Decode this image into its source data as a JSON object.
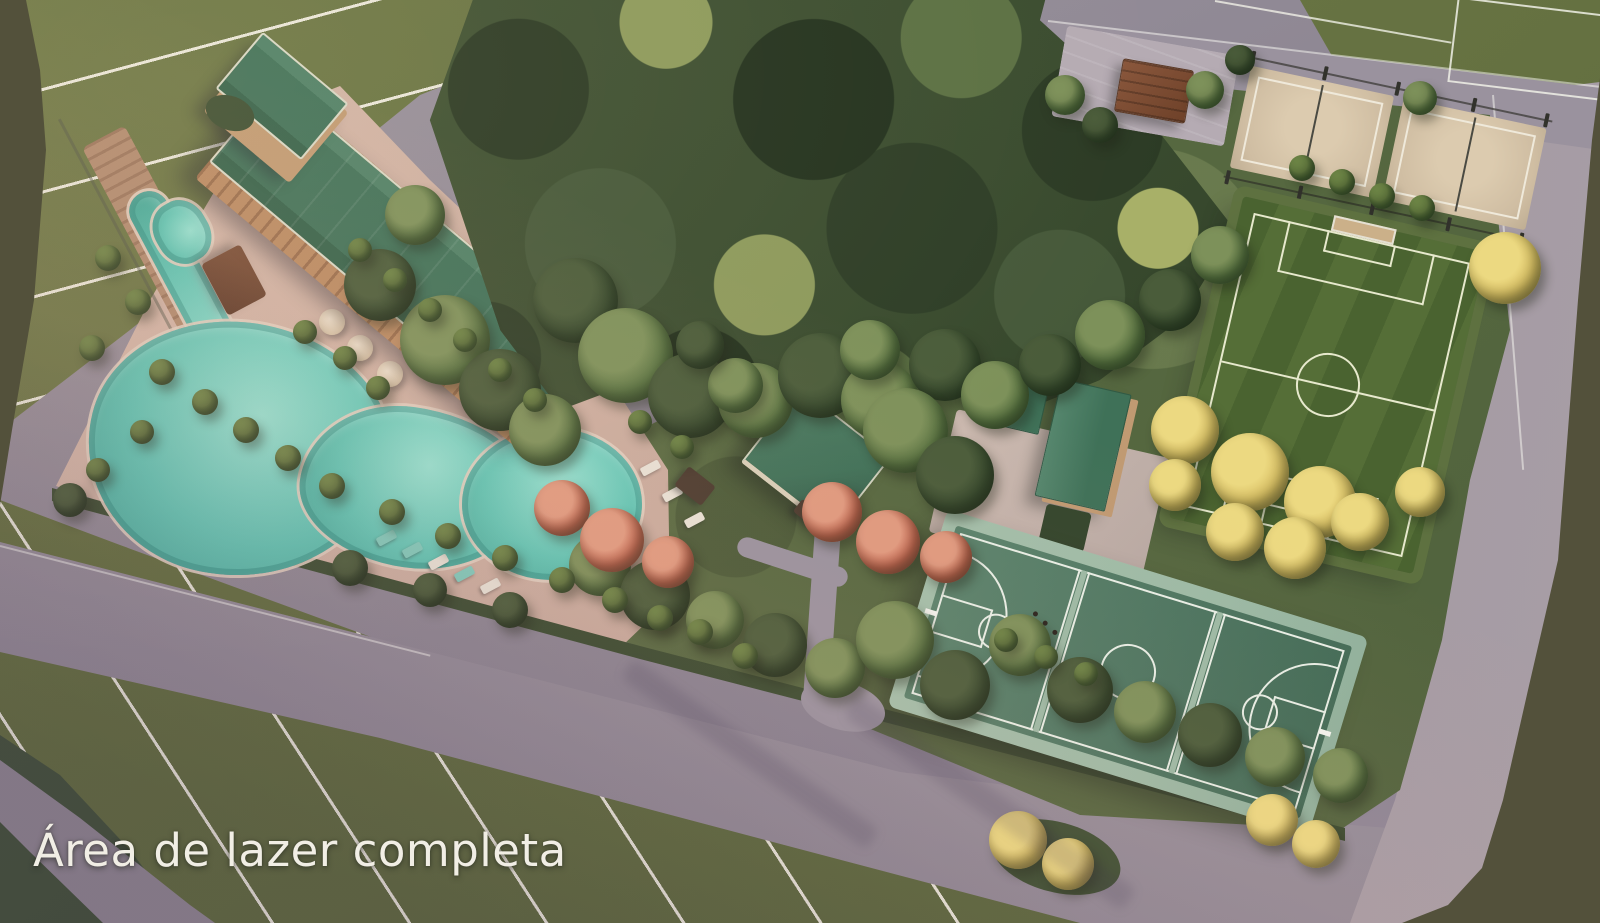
{
  "caption": {
    "text": "Área de lazer completa"
  },
  "palette": {
    "frame": "#53513b",
    "road": "#8f8894",
    "grass_lot": "#66713f",
    "lawn": "#5a6c41",
    "forest": "#3a4c2f",
    "pool": "#5ec5b4",
    "pool_light": "#93e0d0",
    "roof_green": "#3f7158",
    "deck": "#c9ac9f",
    "wall_tan": "#b98a62",
    "court_dark": "#4c7560",
    "court_light": "#9cbaa5",
    "field_green": "#4a6330",
    "field_line": "#e7e9cd",
    "sand": "#cfbda2",
    "ipe_yellow": "#d3b95e",
    "flower_red": "#c4624c",
    "line_white": "#e9e7da",
    "caption_color": "#f1eee5"
  }
}
